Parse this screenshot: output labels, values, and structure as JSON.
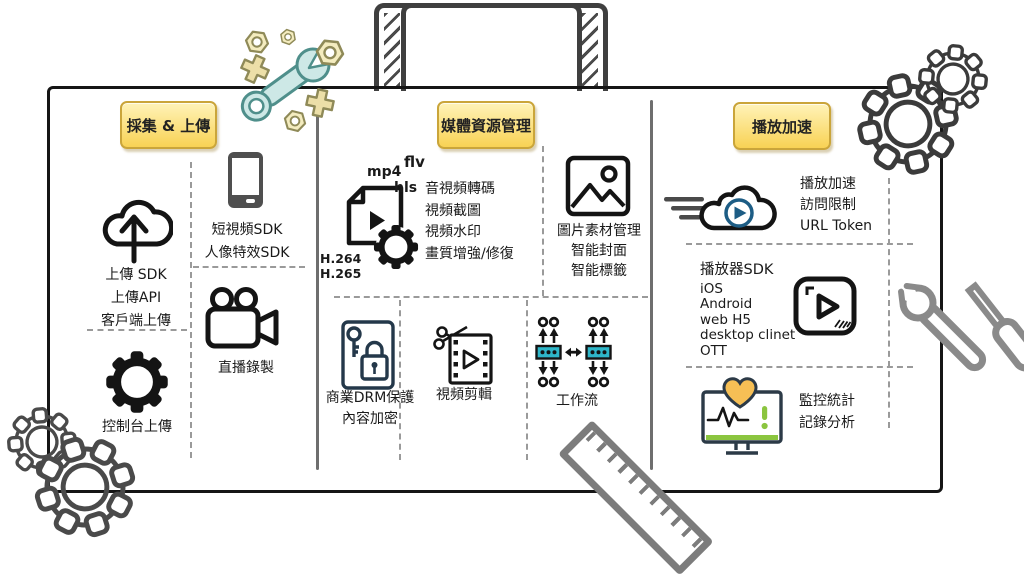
{
  "diagram": {
    "kind": "hand-drawn toolbox style product architecture diagram (video cloud platform)",
    "sections": [
      {
        "title": "採集 & 上傳",
        "upload_lines": [
          "上傳 SDK",
          "上傳API",
          "客戶端上傳"
        ],
        "sdk_lines": [
          "短視頻SDK",
          "人像特效SDK"
        ],
        "live_label": "直播錄製",
        "console_label": "控制台上傳"
      },
      {
        "title": "媒體資源管理",
        "file_formats": {
          "mp4": "mp4",
          "flv": "flv",
          "hls": "hls",
          "h264": "H.264",
          "h265": "H.265"
        },
        "transcode_lines": [
          "音視頻轉碼",
          "視頻截圖",
          "視頻水印",
          "畫質增強/修復"
        ],
        "image_lines": [
          "圖片素材管理",
          "智能封面",
          "智能標籤"
        ],
        "drm_lines": [
          "商業DRM保護",
          "內容加密"
        ],
        "edit_label": "視頻剪輯",
        "workflow_label": "工作流"
      },
      {
        "title": "播放加速",
        "cdn_lines": [
          "播放加速",
          "訪問限制",
          "URL Token"
        ],
        "player_lines": [
          "播放器SDK",
          "iOS",
          "Android",
          "web H5",
          "desktop clinet",
          "OTT"
        ],
        "monitor_lines": [
          "監控統計",
          "記錄分析"
        ]
      }
    ],
    "icons": [
      "cloud-upload-icon",
      "phone-icon",
      "video-camera-icon",
      "gear-icon",
      "file-transcode-icon",
      "picture-icon",
      "drm-lock-key-icon",
      "video-edit-icon",
      "workflow-icon",
      "cloud-play-icon",
      "player-icon",
      "monitor-health-icon",
      "wrench-icon",
      "hex-nut-icon",
      "sketch-gear-icon",
      "ruler-icon",
      "screwdriver-icon",
      "suitcase-handle"
    ],
    "colors": {
      "label_yellow": "#f8d254",
      "label_border": "#caa53a",
      "workflow_teal": "#2eb6c9",
      "wrench_teal": "#cde8e6",
      "heart_orange": "#f6bf55",
      "health_green": "#8bc53f",
      "play_blue": "#1d5d85",
      "drm_navy": "#24384a",
      "ink": "#151515",
      "gray_tool": "#8a8a8a"
    }
  }
}
